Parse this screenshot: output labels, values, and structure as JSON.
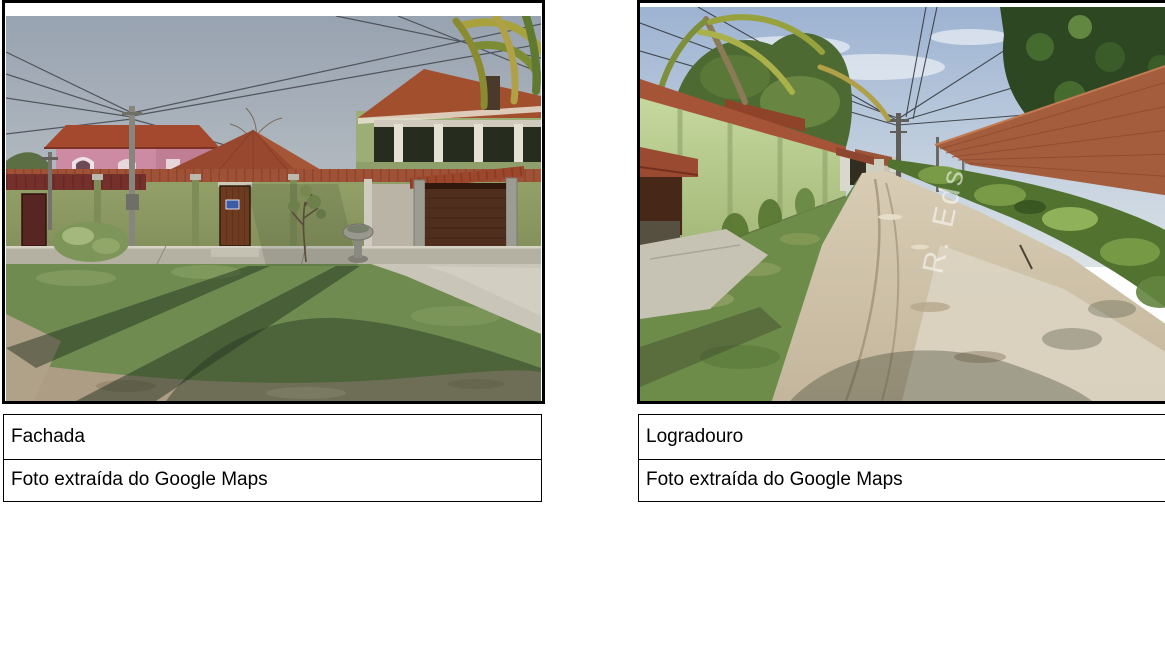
{
  "panels": [
    {
      "title": "Fachada",
      "source": "Foto extraída do Google Maps",
      "photo_subject": "street-view photo of house facade with green wall, terracotta roofs, pink two-story house, grass and dirt foreground"
    },
    {
      "title": "Logradouro",
      "source": "Foto extraída do Google Maps",
      "photo_subject": "street-view photo of unpaved dirt road between green wall and brick wall with vegetation",
      "street_label_watermark": "R. Eds"
    }
  ],
  "colors": {
    "frame_border": "#000000",
    "caption_border": "#000000",
    "caption_text": "#000000",
    "page_background": "#ffffff"
  }
}
